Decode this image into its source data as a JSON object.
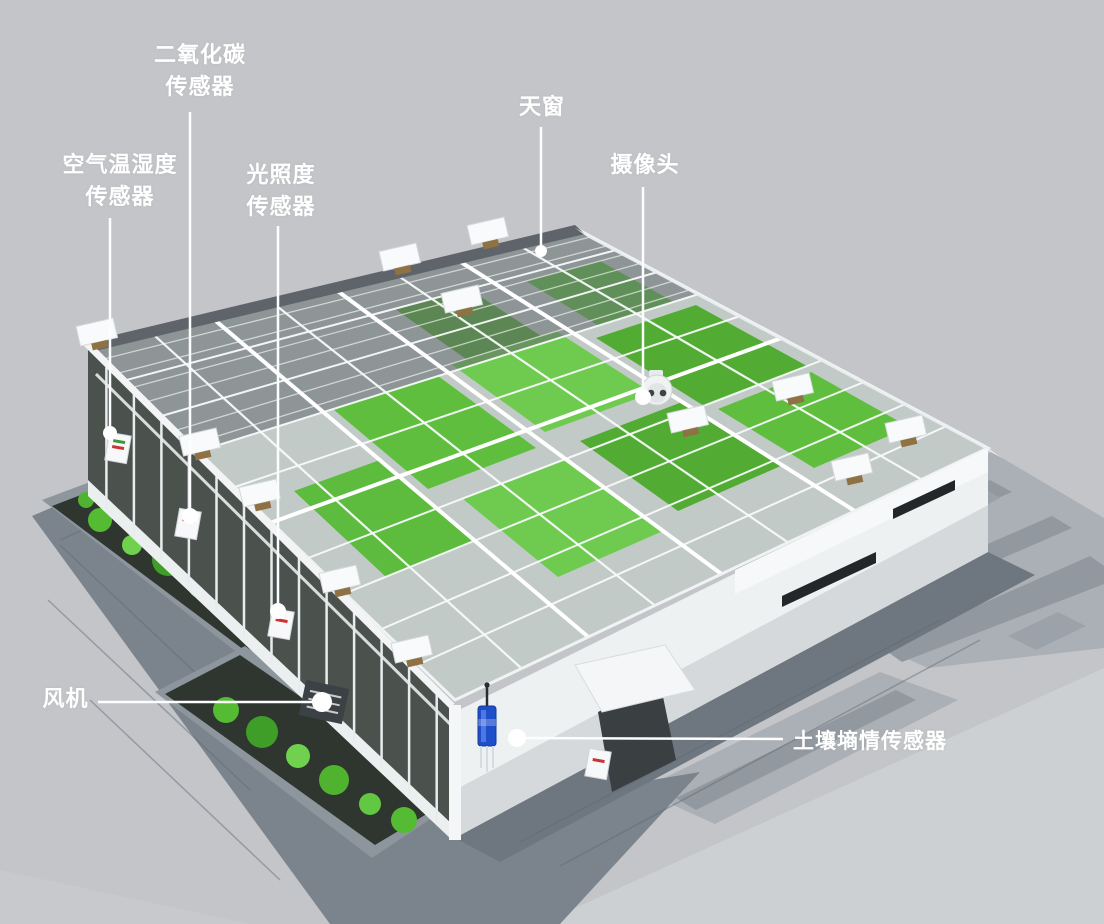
{
  "diagram": {
    "type": "annotated-3d-greenhouse-illustration",
    "subject": "smart greenhouse with IoT sensors"
  },
  "labels": {
    "co2": "二氧化碳\n传感器",
    "air": "空气温湿度\n传感器",
    "light": "光照度\n传感器",
    "skylight": "天窗",
    "camera": "摄像头",
    "fan": "风机",
    "soil": "土壤墒情传感器"
  },
  "colors": {
    "background": "#c3c5c8",
    "label_text": "#ffffff",
    "leader_line": "#ffffff",
    "structure_white": "#f2f4f5",
    "glass_dark": "#4b524e",
    "plant_green": "#57bd33",
    "pavement": "#7b848c",
    "soil_sensor_blue": "#1f4ecb"
  }
}
